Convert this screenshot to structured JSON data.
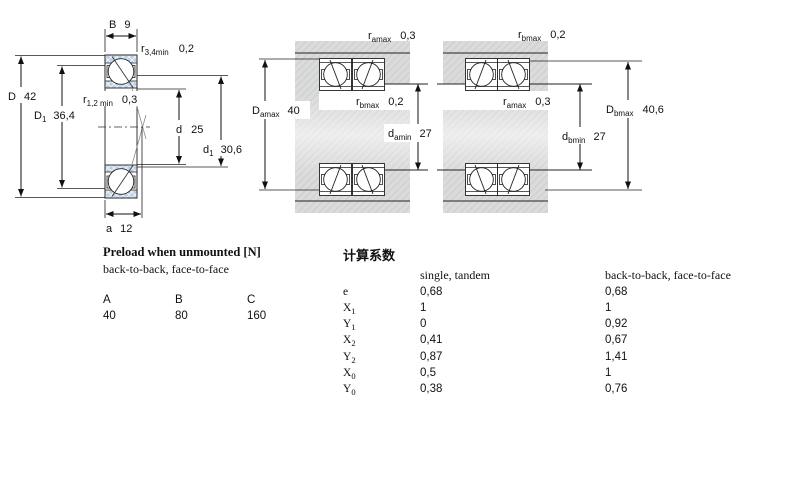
{
  "drawing": {
    "left": {
      "width": {
        "m": "B",
        "v": "9"
      },
      "r34": {
        "m": "r",
        "s": "3,4min",
        "v": "0,2"
      },
      "D": {
        "m": "D",
        "v": "42"
      },
      "D1": {
        "m": "D",
        "s": "1",
        "v": "36,4"
      },
      "r12": {
        "m": "r",
        "s": "1,2 min",
        "v": "0,3"
      },
      "d": {
        "m": "d",
        "v": "25"
      },
      "d1": {
        "m": "d",
        "s": "1",
        "v": "30,6"
      },
      "a": {
        "m": "a",
        "v": "12"
      }
    },
    "mid": {
      "ra": {
        "m": "r",
        "s": "amax",
        "v": "0,3"
      },
      "rb": {
        "m": "r",
        "s": "bmax",
        "v": "0,2"
      },
      "Da": {
        "m": "D",
        "s": "amax",
        "v": "40"
      },
      "da": {
        "m": "d",
        "s": "amin",
        "v": "27"
      }
    },
    "right": {
      "rb": {
        "m": "r",
        "s": "bmax",
        "v": "0,2"
      },
      "ra": {
        "m": "r",
        "s": "amax",
        "v": "0,3"
      },
      "Db": {
        "m": "D",
        "s": "bmax",
        "v": "40,6"
      },
      "db": {
        "m": "d",
        "s": "bmin",
        "v": "27"
      }
    }
  },
  "preload": {
    "title": "Preload when unmounted [N]",
    "subtitle": "back-to-back, face-to-face",
    "columns": [
      "A",
      "B",
      "C"
    ],
    "values": [
      "40",
      "80",
      "160"
    ]
  },
  "factors": {
    "title": "计算系数",
    "col_single": "single, tandem",
    "col_paired": "back-to-back, face-to-face",
    "rows": [
      {
        "m": "e",
        "s": "",
        "v1": "0,68",
        "v2": "0,68"
      },
      {
        "m": "X",
        "s": "1",
        "v1": "1",
        "v2": "1"
      },
      {
        "m": "Y",
        "s": "1",
        "v1": "0",
        "v2": "0,92"
      },
      {
        "m": "X",
        "s": "2",
        "v1": "0,41",
        "v2": "0,67"
      },
      {
        "m": "Y",
        "s": "2",
        "v1": "0,87",
        "v2": "1,41"
      },
      {
        "m": "X",
        "s": "0",
        "v1": "0,5",
        "v2": "1"
      },
      {
        "m": "Y",
        "s": "0",
        "v1": "0,38",
        "v2": "0,76"
      }
    ]
  }
}
